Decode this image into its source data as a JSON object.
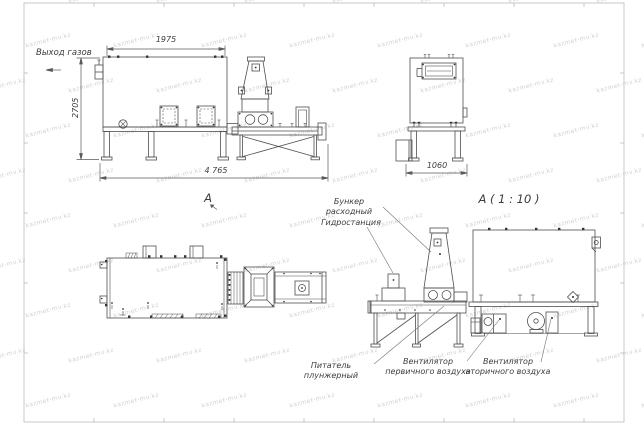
{
  "meta": {
    "type": "engineering-drawing",
    "language": "ru"
  },
  "watermark": {
    "text": "kazmet-mv.kz"
  },
  "labels": {
    "gas_outlet": "Выход газов",
    "view_marker": "А",
    "detail_title": "А ( 1 : 10 )",
    "feed_hopper": "Бункер расходный",
    "hydraulic_station": "Гидростанция",
    "plunger_feeder": "Питатель плунжерный",
    "primary_air_fan": "Вентилятор\nпервичного воздуха",
    "secondary_air_fan": "Вентилятор\nвторичного воздуха"
  },
  "dimensions": {
    "furnace_top_width": "1975",
    "furnace_height": "2705",
    "overall_length": "4 765",
    "furnace_end_width": "1060"
  },
  "colors": {
    "line": "#4f4f4f",
    "dim": "#5a5a5a",
    "frame": "#b9bdbb",
    "text": "#3c3c3c",
    "watermark": "#cfd4d0"
  }
}
